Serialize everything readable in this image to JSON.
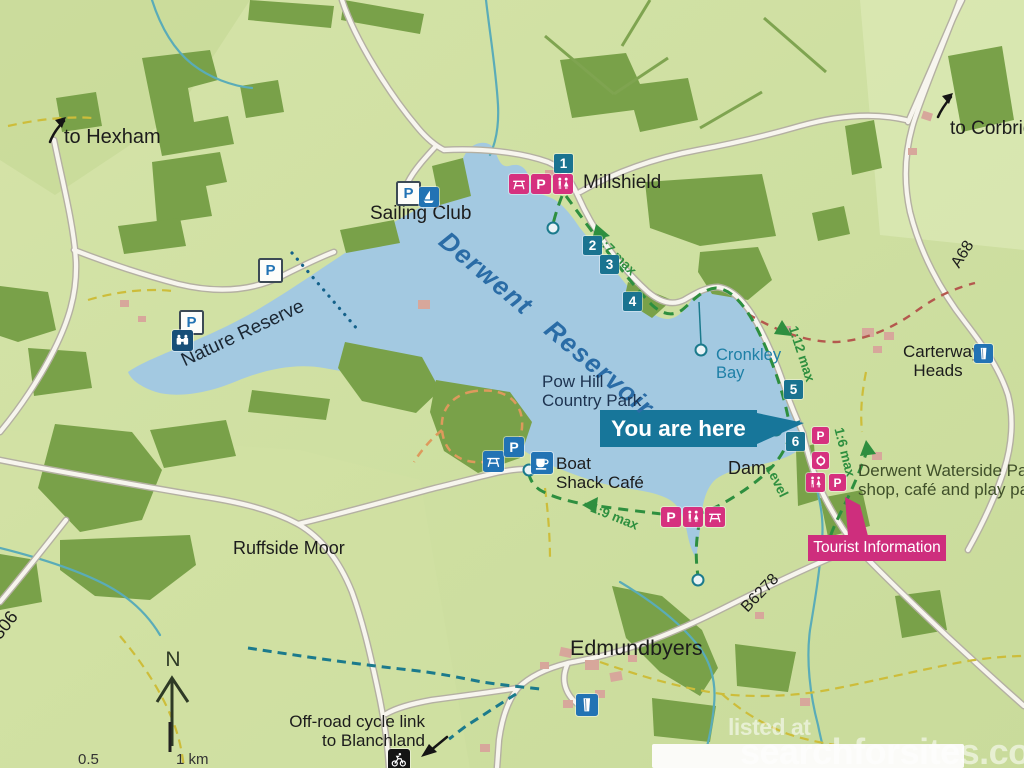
{
  "labels": {
    "to_hexham": "to Hexham",
    "to_corbridge": "to Corbridge",
    "sailing_club": "Sailing Club",
    "millshield": "Millshield",
    "nature_reserve": "Nature Reserve",
    "reservoir": "Derwent Reservoir",
    "cronkley_1": "Cronkley",
    "cronkley_2": "Bay",
    "carterway_1": "Carterway",
    "carterway_2": "Heads",
    "pow_hill_1": "Pow Hill",
    "pow_hill_2": "Country Park",
    "you_are_here": "You are here",
    "dam": "Dam",
    "waterside_1": "Derwent Waterside Park",
    "waterside_2": "shop, café and play park",
    "tourist_information": "Tourist Information",
    "boat_shack_1": "Boat",
    "boat_shack_2": "Shack Café",
    "ruffside_moor": "Ruffside Moor",
    "edmundbyers": "Edmundbyers",
    "cycle_link_1": "Off-road cycle link",
    "cycle_link_2": "to Blanchland",
    "north": "N",
    "road_a68": "A68",
    "road_b6278": "B6278",
    "road_b6306": "B6306",
    "grad_1_7": "1:7 max",
    "grad_1_12": "1:12 max",
    "grad_1_9": "1:9 max",
    "grad_1_6": "1:6 max",
    "grad_level": "Level",
    "scale_frag_1": "0.5",
    "scale_frag_2": "1 km"
  },
  "markers": [
    {
      "number": "1"
    },
    {
      "number": "2"
    },
    {
      "number": "3"
    },
    {
      "number": "4"
    },
    {
      "number": "5"
    },
    {
      "number": "6"
    }
  ],
  "icons": {
    "parking_glyph": "P"
  },
  "watermark": {
    "line1": "listed at",
    "line2": "searchforsites.co.uk"
  },
  "colors": {
    "land": "#cfe0a2",
    "water": "#a3c9e1",
    "woodland": "#79a149",
    "teal_marker": "#1a7390",
    "pink": "#d6317f",
    "blue_icon": "#2273b4",
    "route_green": "#2e8f3f",
    "reservoir_text": "#2a6ca6"
  }
}
